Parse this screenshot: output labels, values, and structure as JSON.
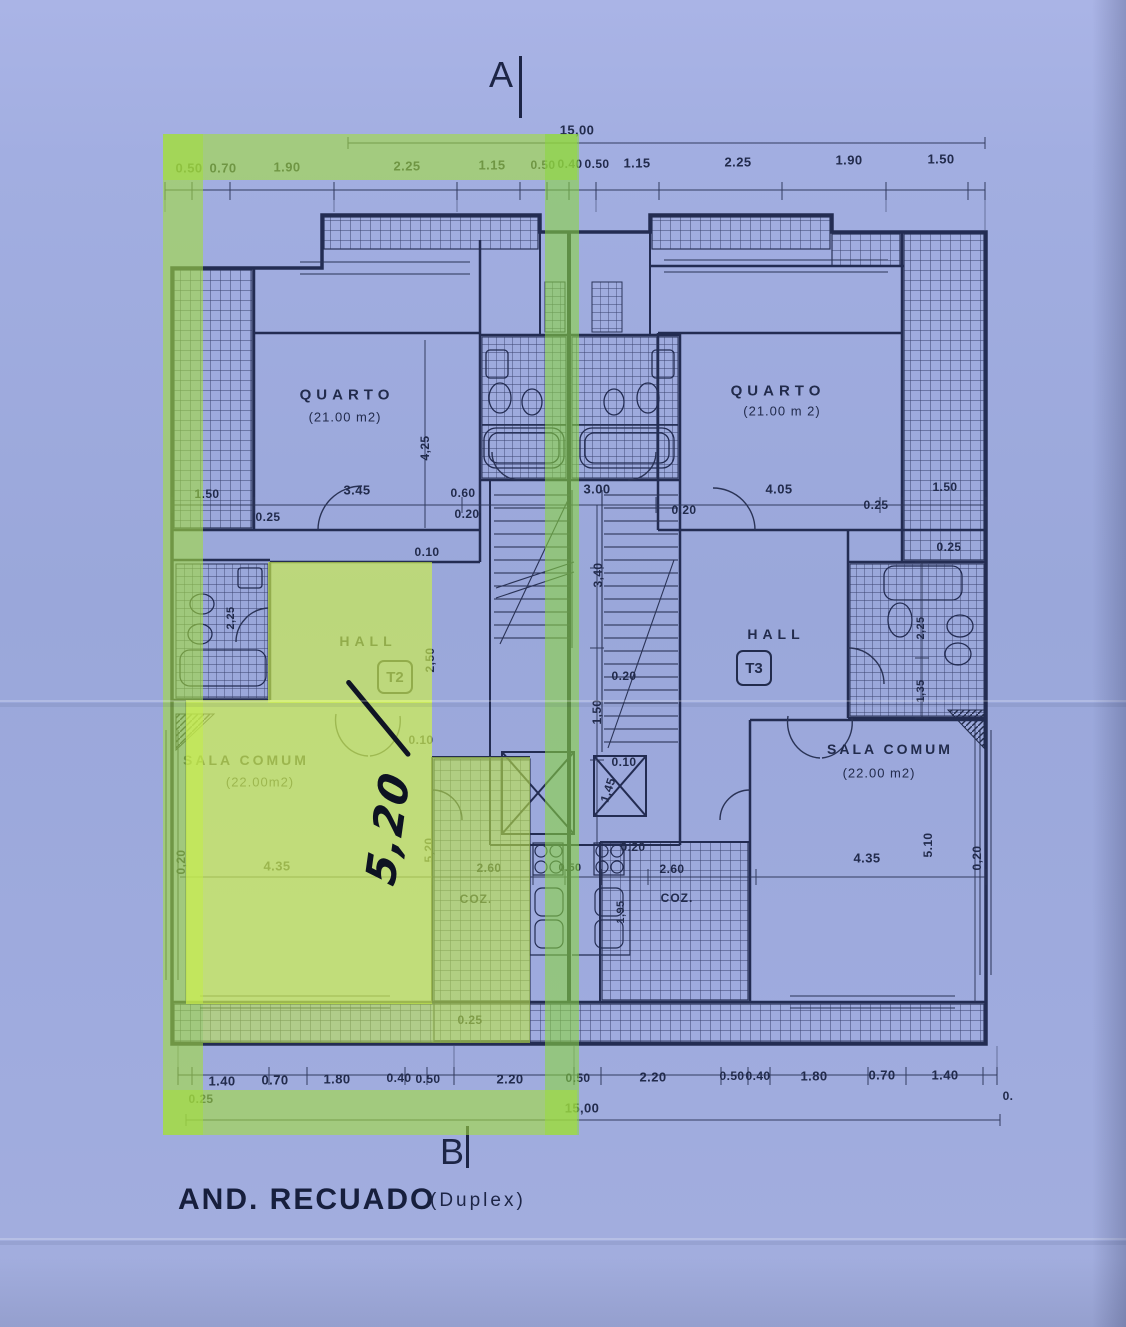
{
  "title": {
    "main": "AND. RECUADO",
    "sub": "(Duplex)"
  },
  "markers": {
    "top": "A",
    "bottom": "B"
  },
  "overall": {
    "top": "15,00",
    "bottom": "15,00"
  },
  "rooms": {
    "quarto_left": {
      "name": "QUARTO",
      "area": "(21.00 m2)"
    },
    "quarto_right": {
      "name": "QUARTO",
      "area": "(21.00 m 2)"
    },
    "hall_left": {
      "name": "HALL",
      "unit": "T2"
    },
    "hall_right": {
      "name": "HALL",
      "unit": "T3"
    },
    "sala_left": {
      "name": "SALA COMUM",
      "area": "(22.00m2)"
    },
    "sala_right": {
      "name": "SALA COMUM",
      "area": "(22.00 m2)"
    },
    "coz_left": {
      "name": "COZ."
    },
    "coz_right": {
      "name": "COZ."
    }
  },
  "annotations": {
    "handwritten_dim": "5,20"
  },
  "colors": {
    "paper": "#9fabdf",
    "ink": "#232c52",
    "highlighter": "#c3ee5e"
  },
  "dim_labels": [
    {
      "t": "0.50",
      "x": 189,
      "y": 168
    },
    {
      "t": "0.70",
      "x": 223,
      "y": 168
    },
    {
      "t": "1.90",
      "x": 287,
      "y": 167
    },
    {
      "t": "2.25",
      "x": 407,
      "y": 166
    },
    {
      "t": "1.15",
      "x": 492,
      "y": 165
    },
    {
      "t": "0.50",
      "x": 543,
      "y": 165,
      "fs": 12
    },
    {
      "t": "0.40",
      "x": 570,
      "y": 164,
      "fs": 12
    },
    {
      "t": "0.50",
      "x": 597,
      "y": 164,
      "fs": 12
    },
    {
      "t": "1.15",
      "x": 637,
      "y": 163
    },
    {
      "t": "2.25",
      "x": 738,
      "y": 162
    },
    {
      "t": "1.90",
      "x": 849,
      "y": 160
    },
    {
      "t": "1.50",
      "x": 941,
      "y": 159
    },
    {
      "t": "1.50",
      "x": 207,
      "y": 494,
      "fs": 12
    },
    {
      "t": "3.45",
      "x": 357,
      "y": 490
    },
    {
      "t": "0.25",
      "x": 268,
      "y": 517,
      "fs": 12
    },
    {
      "t": "0.60",
      "x": 463,
      "y": 493,
      "fs": 12
    },
    {
      "t": "0.20",
      "x": 467,
      "y": 514,
      "fs": 12
    },
    {
      "t": "3.00",
      "x": 597,
      "y": 489
    },
    {
      "t": "0.20",
      "x": 684,
      "y": 510,
      "fs": 12
    },
    {
      "t": "4.05",
      "x": 779,
      "y": 489
    },
    {
      "t": "0.25",
      "x": 876,
      "y": 505,
      "fs": 12
    },
    {
      "t": "1.50",
      "x": 945,
      "y": 487,
      "fs": 12
    },
    {
      "t": "0.25",
      "x": 949,
      "y": 547,
      "fs": 12
    },
    {
      "t": "0.10",
      "x": 427,
      "y": 552,
      "fs": 12
    },
    {
      "t": "4,25",
      "x": 425,
      "y": 448,
      "r": -90,
      "fs": 12
    },
    {
      "t": "3,40",
      "x": 598,
      "y": 575,
      "r": -90,
      "fs": 12
    },
    {
      "t": "2,50",
      "x": 430,
      "y": 660,
      "r": -90,
      "fs": 12
    },
    {
      "t": "0.20",
      "x": 624,
      "y": 676,
      "fs": 12
    },
    {
      "t": "1,50",
      "x": 597,
      "y": 712,
      "r": -90,
      "fs": 12
    },
    {
      "t": "2,25",
      "x": 231,
      "y": 618,
      "r": -90,
      "fs": 11
    },
    {
      "t": "0.10",
      "x": 421,
      "y": 740,
      "fs": 12
    },
    {
      "t": "0.10",
      "x": 624,
      "y": 762,
      "fs": 12
    },
    {
      "t": "1,45",
      "x": 608,
      "y": 790,
      "r": -72,
      "fs": 12
    },
    {
      "t": "2,25",
      "x": 921,
      "y": 628,
      "r": -90,
      "fs": 11
    },
    {
      "t": "1,35",
      "x": 921,
      "y": 691,
      "r": -90,
      "fs": 11
    },
    {
      "t": "0,20",
      "x": 181,
      "y": 862,
      "r": -90,
      "fs": 12
    },
    {
      "t": "4.35",
      "x": 277,
      "y": 866
    },
    {
      "t": "5,20",
      "x": 429,
      "y": 850,
      "r": -90,
      "fs": 12
    },
    {
      "t": "2.60",
      "x": 489,
      "y": 868,
      "fs": 12
    },
    {
      "t": "0.50",
      "x": 570,
      "y": 868,
      "fs": 11
    },
    {
      "t": "0.20",
      "x": 633,
      "y": 847,
      "fs": 12
    },
    {
      "t": "2.60",
      "x": 672,
      "y": 869,
      "fs": 12
    },
    {
      "t": "1,95",
      "x": 621,
      "y": 912,
      "r": -90,
      "fs": 11
    },
    {
      "t": "4.35",
      "x": 867,
      "y": 858
    },
    {
      "t": "5.10",
      "x": 928,
      "y": 845,
      "r": -90,
      "fs": 12
    },
    {
      "t": "0,20",
      "x": 977,
      "y": 858,
      "r": -90,
      "fs": 12
    },
    {
      "t": "0.25",
      "x": 470,
      "y": 1020,
      "fs": 12
    },
    {
      "t": "0.25",
      "x": 201,
      "y": 1099,
      "fs": 12
    },
    {
      "t": "1.40",
      "x": 222,
      "y": 1081
    },
    {
      "t": "0.70",
      "x": 275,
      "y": 1080
    },
    {
      "t": "1.80",
      "x": 337,
      "y": 1079
    },
    {
      "t": "0.40",
      "x": 399,
      "y": 1078,
      "fs": 12
    },
    {
      "t": "0.50",
      "x": 428,
      "y": 1079,
      "fs": 12
    },
    {
      "t": "2.20",
      "x": 510,
      "y": 1079
    },
    {
      "t": "0.50",
      "x": 578,
      "y": 1078,
      "fs": 12
    },
    {
      "t": "2.20",
      "x": 653,
      "y": 1077
    },
    {
      "t": "0.50",
      "x": 732,
      "y": 1076,
      "fs": 12
    },
    {
      "t": "0.40",
      "x": 758,
      "y": 1076,
      "fs": 12
    },
    {
      "t": "1.80",
      "x": 814,
      "y": 1076
    },
    {
      "t": "0.70",
      "x": 882,
      "y": 1075
    },
    {
      "t": "1.40",
      "x": 945,
      "y": 1075
    },
    {
      "t": "0.",
      "x": 1008,
      "y": 1096,
      "fs": 12
    }
  ]
}
